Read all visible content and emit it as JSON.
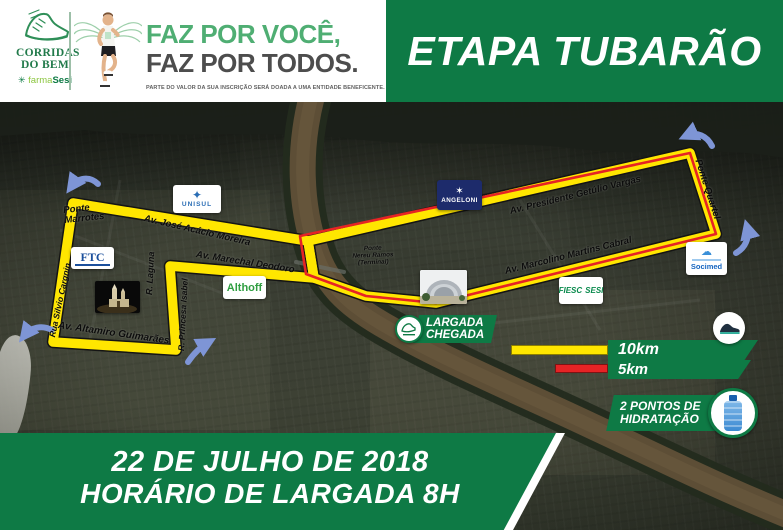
{
  "poster": {
    "event_title": "ETAPA TUBARÃO"
  },
  "header": {
    "logo": {
      "word1": "CORRIDAS",
      "word2": "DO BEM",
      "flower_icon": "✳",
      "farma": "farma",
      "sesi": "Sesi"
    },
    "tagline1": "FAZ POR VOCÊ,",
    "tagline2": "FAZ POR TODOS.",
    "disclaimer": "PARTE DO VALOR DA SUA INSCRIÇÃO SERÁ DOADA A UMA ENTIDADE BENEFICENTE. PARTICIPE E AJUDE."
  },
  "map": {
    "labels": {
      "marrotes1": "Ponte",
      "marrotes2": "Marrotes",
      "jose_acacio": "Av. José Acácio Moreira",
      "marechal": "Av. Marechal Deodoro",
      "silvio": "Rua Silvio Cargnin",
      "laguna": "R. Laguna",
      "princesa": "R. Princesa Isabel",
      "altamiro": "Av. Altamiro Guimarães",
      "nereu1": "Ponte",
      "nereu2": "Nereu Ramos",
      "nereu3": "(Terminal)",
      "getulio": "Av. Presidente Getúlio Vargas",
      "marcolino": "Av. Marcolino Martins Cabral",
      "quartel": "Ponte Quartel"
    },
    "sponsors": {
      "unisul": "UNISUL",
      "unisul_icon": "✦",
      "angeloni": "ANGELONI",
      "angeloni_icon": "✶",
      "ftc": "FTC",
      "althoff": "Althoff",
      "socimed": "Socimed",
      "socimed_icon": "☁",
      "fiesc": "FIESC",
      "sesi": "SESI"
    },
    "start_finish1": "LARGADA",
    "start_finish2": "CHEGADA",
    "legend": {
      "k10": "10km",
      "k5": "5km"
    },
    "hydration1": "2 PONTOS DE",
    "hydration2": "HIDRATAÇÃO"
  },
  "footer": {
    "date": "22 DE JULHO DE 2018",
    "time": "HORÁRIO DE LARGADA 8H"
  },
  "colors": {
    "brand_green": "#0e7a45",
    "tagline_green": "#4fae73",
    "route_yellow": "#ffe600",
    "route_5km_red": "#e62325",
    "arrow_blue": "#7e95d6",
    "river_brown": "#5d4e36",
    "angeloni_navy": "#1d2b6b"
  }
}
